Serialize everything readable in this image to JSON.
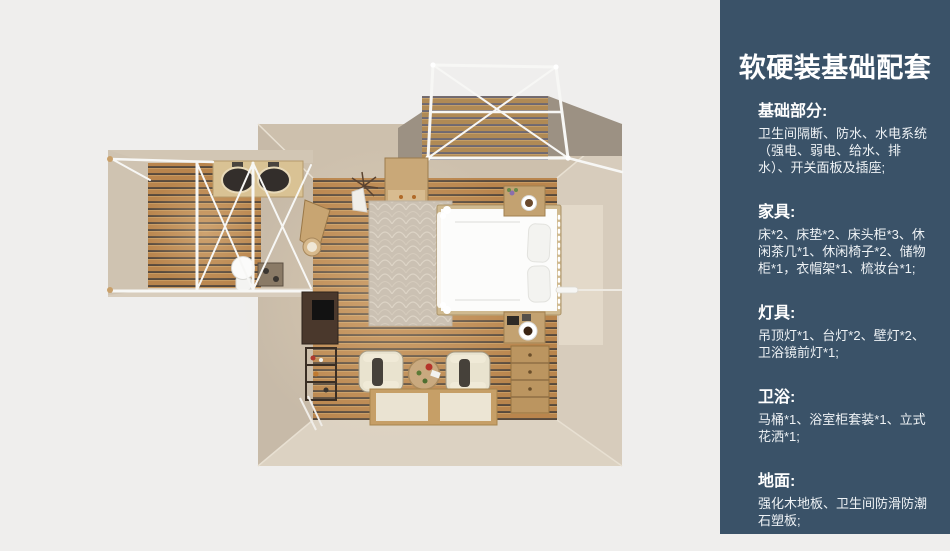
{
  "panel": {
    "title": "软硬装基础配套",
    "sections": [
      {
        "heading": "基础部分:",
        "body": "卫生间隔断、防水、水电系统（强电、弱电、给水、排水）、开关面板及插座;"
      },
      {
        "heading": "家具:",
        "body": "床*2、床垫*2、床头柜*3、休闲茶几*1、休闲椅子*2、储物柜*1，衣帽架*1、梳妆台*1;"
      },
      {
        "heading": "灯具:",
        "body": "吊顶灯*1、台灯*2、壁灯*2、卫浴镜前灯*1;"
      },
      {
        "heading": "卫浴:",
        "body": "马桶*1、浴室柜套装*1、立式花洒*1;"
      },
      {
        "heading": "地面:",
        "body": "强化木地板、卫生间防滑防潮石塑板;"
      }
    ]
  },
  "floorplan": {
    "type": "top-down 3d room render",
    "items": [
      "balcony-truss",
      "bathroom",
      "double-sink-counter",
      "toilet",
      "storage-cabinet",
      "coat-rack",
      "rug",
      "double-bed",
      "nightstand",
      "desk",
      "shelf",
      "armchair",
      "round-tea-table",
      "floor-mats",
      "dresser",
      "wardrobe-door"
    ],
    "colors": {
      "background": "#efeeed",
      "panel_bg": "#3a5268",
      "panel_text": "#eef2f5",
      "wall_beige": "#cfc3b1",
      "floor_wood": "#b9854d",
      "floor_groove": "#57493c",
      "deck_surround": "#9c9183",
      "truss_white": "#f7f7f5",
      "bed_white": "#fcfcfb"
    }
  }
}
